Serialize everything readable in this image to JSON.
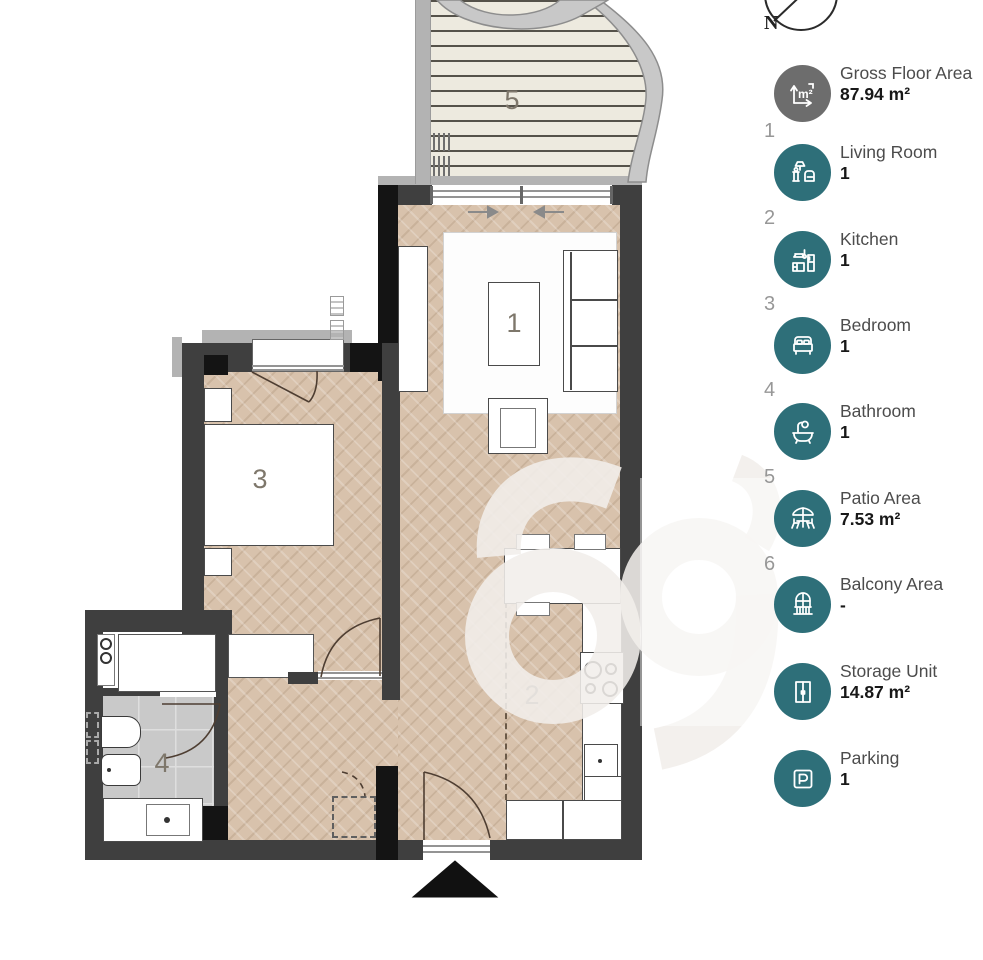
{
  "compass": {
    "label": "N"
  },
  "legend": {
    "items": [
      {
        "number": "",
        "icon": "area-icon",
        "label": "Gross Floor Area",
        "value": "87.94 m²"
      },
      {
        "number": "1",
        "icon": "living-room-icon",
        "label": "Living Room",
        "value": "1"
      },
      {
        "number": "2",
        "icon": "kitchen-icon",
        "label": "Kitchen",
        "value": "1"
      },
      {
        "number": "3",
        "icon": "bedroom-icon",
        "label": "Bedroom",
        "value": "1"
      },
      {
        "number": "4",
        "icon": "bathroom-icon",
        "label": "Bathroom",
        "value": "1"
      },
      {
        "number": "5",
        "icon": "patio-icon",
        "label": "Patio Area",
        "value": "7.53 m²"
      },
      {
        "number": "6",
        "icon": "balcony-icon",
        "label": "Balcony Area",
        "value": "-"
      },
      {
        "number": "",
        "icon": "storage-icon",
        "label": "Storage Unit",
        "value": "14.87 m²"
      },
      {
        "number": "",
        "icon": "parking-icon",
        "label": "Parking",
        "value": "1"
      }
    ]
  },
  "plan": {
    "labels": {
      "living_room": "1",
      "kitchen": "2",
      "bedroom": "3",
      "bathroom": "4",
      "patio": "5"
    }
  },
  "colors": {
    "accent_teal": "#2e6f79",
    "icon_gray": "#6d6d6d",
    "wall_dark": "#3f3f3f",
    "wall_black": "#141414",
    "floor_wood": "#d8c2ac",
    "floor_tile": "#c9c9c9",
    "deck": "#edeadf"
  }
}
